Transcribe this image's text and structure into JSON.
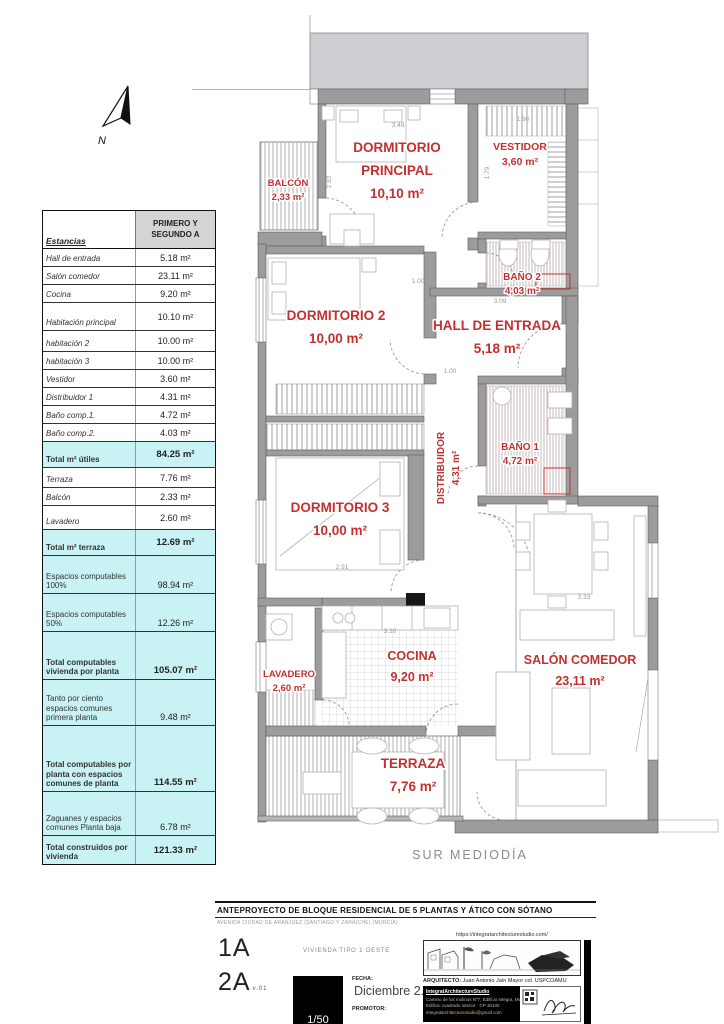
{
  "compass": {
    "label": "N"
  },
  "area_table": {
    "header_col1": "Estancias",
    "header_col2": "PRIMERO  Y SEGUNDO A",
    "rows": [
      {
        "label": "Hall de entrada",
        "value": "5.18 m²",
        "style": "plain",
        "h": 18
      },
      {
        "label": "Salón comedor",
        "value": "23.11 m²",
        "style": "plain",
        "h": 18
      },
      {
        "label": "Cocina",
        "value": "9.20 m²",
        "style": "plain",
        "h": 18
      },
      {
        "label": "Habitación principal",
        "value": "10.10 m²",
        "style": "plain",
        "h": 28
      },
      {
        "label": "habitación 2",
        "value": "10.00 m²",
        "style": "plain",
        "h": 21
      },
      {
        "label": "habitación 3",
        "value": "10.00 m²",
        "style": "plain",
        "h": 18
      },
      {
        "label": "Vestidor",
        "value": "3.60 m²",
        "style": "plain",
        "h": 18
      },
      {
        "label": "Distribuidor 1",
        "value": "4.31 m²",
        "style": "plain",
        "h": 18
      },
      {
        "label": "Baño comp.1.",
        "value": "4.72 m²",
        "style": "plain",
        "h": 18
      },
      {
        "label": "Baño comp.2.",
        "value": "4.03 m²",
        "style": "plain",
        "h": 18
      },
      {
        "label": "Total m² útiles",
        "value": "84.25 m²",
        "style": "total",
        "h": 26
      },
      {
        "label": "Terraza",
        "value": "7.76 m²",
        "style": "plain",
        "h": 20
      },
      {
        "label": "Balcón",
        "value": "2.33 m²",
        "style": "plain",
        "h": 18
      },
      {
        "label": "Lavadero",
        "value": "2.60 m²",
        "style": "plain",
        "h": 24
      },
      {
        "label": "Total m² terraza",
        "value": "12.69 m²",
        "style": "total",
        "h": 26
      },
      {
        "label": "Espacios computables 100%",
        "value": "98.94 m²",
        "style": "cyan",
        "h": 38
      },
      {
        "label": "Espacios computables 50%",
        "value": "12.26 m²",
        "style": "cyan",
        "h": 38
      },
      {
        "label": "Total computables vivienda por planta",
        "value": "105.07 m²",
        "style": "total",
        "h": 48
      },
      {
        "label": "Tanto por ciento espacios comunes primera planta",
        "value": "9.48 m²",
        "style": "cyan",
        "h": 46
      },
      {
        "label": "Total computables por planta con espacios comunes de planta",
        "value": "114.55 m²",
        "style": "total",
        "h": 66
      },
      {
        "label": "Zaguanes y espacios comunes Planta baja",
        "value": "6.78 m²",
        "style": "cyan",
        "h": 44
      },
      {
        "label": "Total construidos por vivienda",
        "value": "121.33 m²",
        "style": "total",
        "h": 28
      }
    ]
  },
  "plan": {
    "south_label": "SUR MEDIODÍA",
    "rooms": [
      {
        "lines": [
          "BALCÓN",
          "2,33 m²"
        ],
        "x": 288,
        "y": 186,
        "size": 9.5,
        "gap": 14
      },
      {
        "lines": [
          "DORMITORIO",
          "PRINCIPAL",
          "10,10 m²"
        ],
        "x": 397,
        "y": 152,
        "size": 13.5,
        "gap": 23
      },
      {
        "lines": [
          "VESTIDOR",
          "3,60 m²"
        ],
        "x": 520,
        "y": 150,
        "size": 10.5,
        "gap": 15
      },
      {
        "lines": [
          "BAÑO 2",
          "4,03 m²"
        ],
        "x": 522,
        "y": 280,
        "size": 10,
        "gap": 14
      },
      {
        "lines": [
          "DORMITORIO 2",
          "10,00 m²"
        ],
        "x": 336,
        "y": 320,
        "size": 13.5,
        "gap": 23
      },
      {
        "lines": [
          "HALL DE ENTRADA",
          "5,18 m²"
        ],
        "x": 497,
        "y": 330,
        "size": 13.5,
        "gap": 23
      },
      {
        "lines": [
          "BAÑO 1",
          "4,72 m²"
        ],
        "x": 520,
        "y": 450,
        "size": 10,
        "gap": 14
      },
      {
        "lines": [
          "DISTRIBUIDOR",
          "4,31 m²"
        ],
        "x": 444,
        "y": 468,
        "size": 10,
        "gap": 15,
        "rot": -90
      },
      {
        "lines": [
          "DORMITORIO 3",
          "10,00 m²"
        ],
        "x": 340,
        "y": 512,
        "size": 13.5,
        "gap": 23
      },
      {
        "lines": [
          "LAVADERO",
          "2,60 m²"
        ],
        "x": 289,
        "y": 677,
        "size": 9.5,
        "gap": 14
      },
      {
        "lines": [
          "COCINA",
          "9,20 m²"
        ],
        "x": 412,
        "y": 660,
        "size": 12.5,
        "gap": 21
      },
      {
        "lines": [
          "SALÓN COMEDOR",
          "23,11 m²"
        ],
        "x": 580,
        "y": 664,
        "size": 12.5,
        "gap": 21
      },
      {
        "lines": [
          "TERRAZA",
          "7,76 m²"
        ],
        "x": 413,
        "y": 768,
        "size": 13.5,
        "gap": 23
      }
    ],
    "dims": [
      {
        "t": "3.48",
        "x": 398,
        "y": 127
      },
      {
        "t": "2.92",
        "x": 331,
        "y": 182,
        "r": -90
      },
      {
        "t": "1.90",
        "x": 523,
        "y": 121
      },
      {
        "t": "1.79",
        "x": 489,
        "y": 173,
        "r": -90
      },
      {
        "t": "1.00",
        "x": 418,
        "y": 283
      },
      {
        "t": "3.09",
        "x": 500,
        "y": 303
      },
      {
        "t": "1.00",
        "x": 450,
        "y": 373
      },
      {
        "t": "2.91",
        "x": 342,
        "y": 569
      },
      {
        "t": "3.10",
        "x": 390,
        "y": 633
      },
      {
        "t": "3.33",
        "x": 584,
        "y": 599
      }
    ]
  },
  "title_block": {
    "project_title": "ANTEPROYECTO DE BLOQUE RESIDENCIAL DE 5 PLANTAS Y ÁTICO CON SÓTANO",
    "address": "AVENIDA CIUDAD DE ARANJUEZ (SANTIAGO Y ZARAICHE) (MURCIA)",
    "sheet_code_1": "1A",
    "sheet_code_2": "2A",
    "version": "v.01",
    "drawing_name": "VIVIENDA TIPO 1 OESTE",
    "scale": "1/50",
    "fecha_label": "FECHA:",
    "fecha_value": "Diciembre 2.021",
    "promotor_label": "PROMOTOR:",
    "website": "https://integratarchitecturestudio.com/",
    "architect_label": "ARQUITECTO:",
    "architect_name": "Juan Antonio Jaín Mayor col. USPCOAMU",
    "studio_box": {
      "lines": [
        "IntegratArchitectureStudio",
        "Camino de los molinos Nº7, Edificio Integra, Murcia",
        "Edificio cuadrado interior · CP 30100",
        "integratarchitecturestudio@gmail.com"
      ]
    }
  },
  "colors": {
    "accent_red": "#c23030",
    "cyan": "#c9f2f5",
    "header_gray": "#d4d4d4",
    "wall_gray": "#9c9c9c"
  }
}
